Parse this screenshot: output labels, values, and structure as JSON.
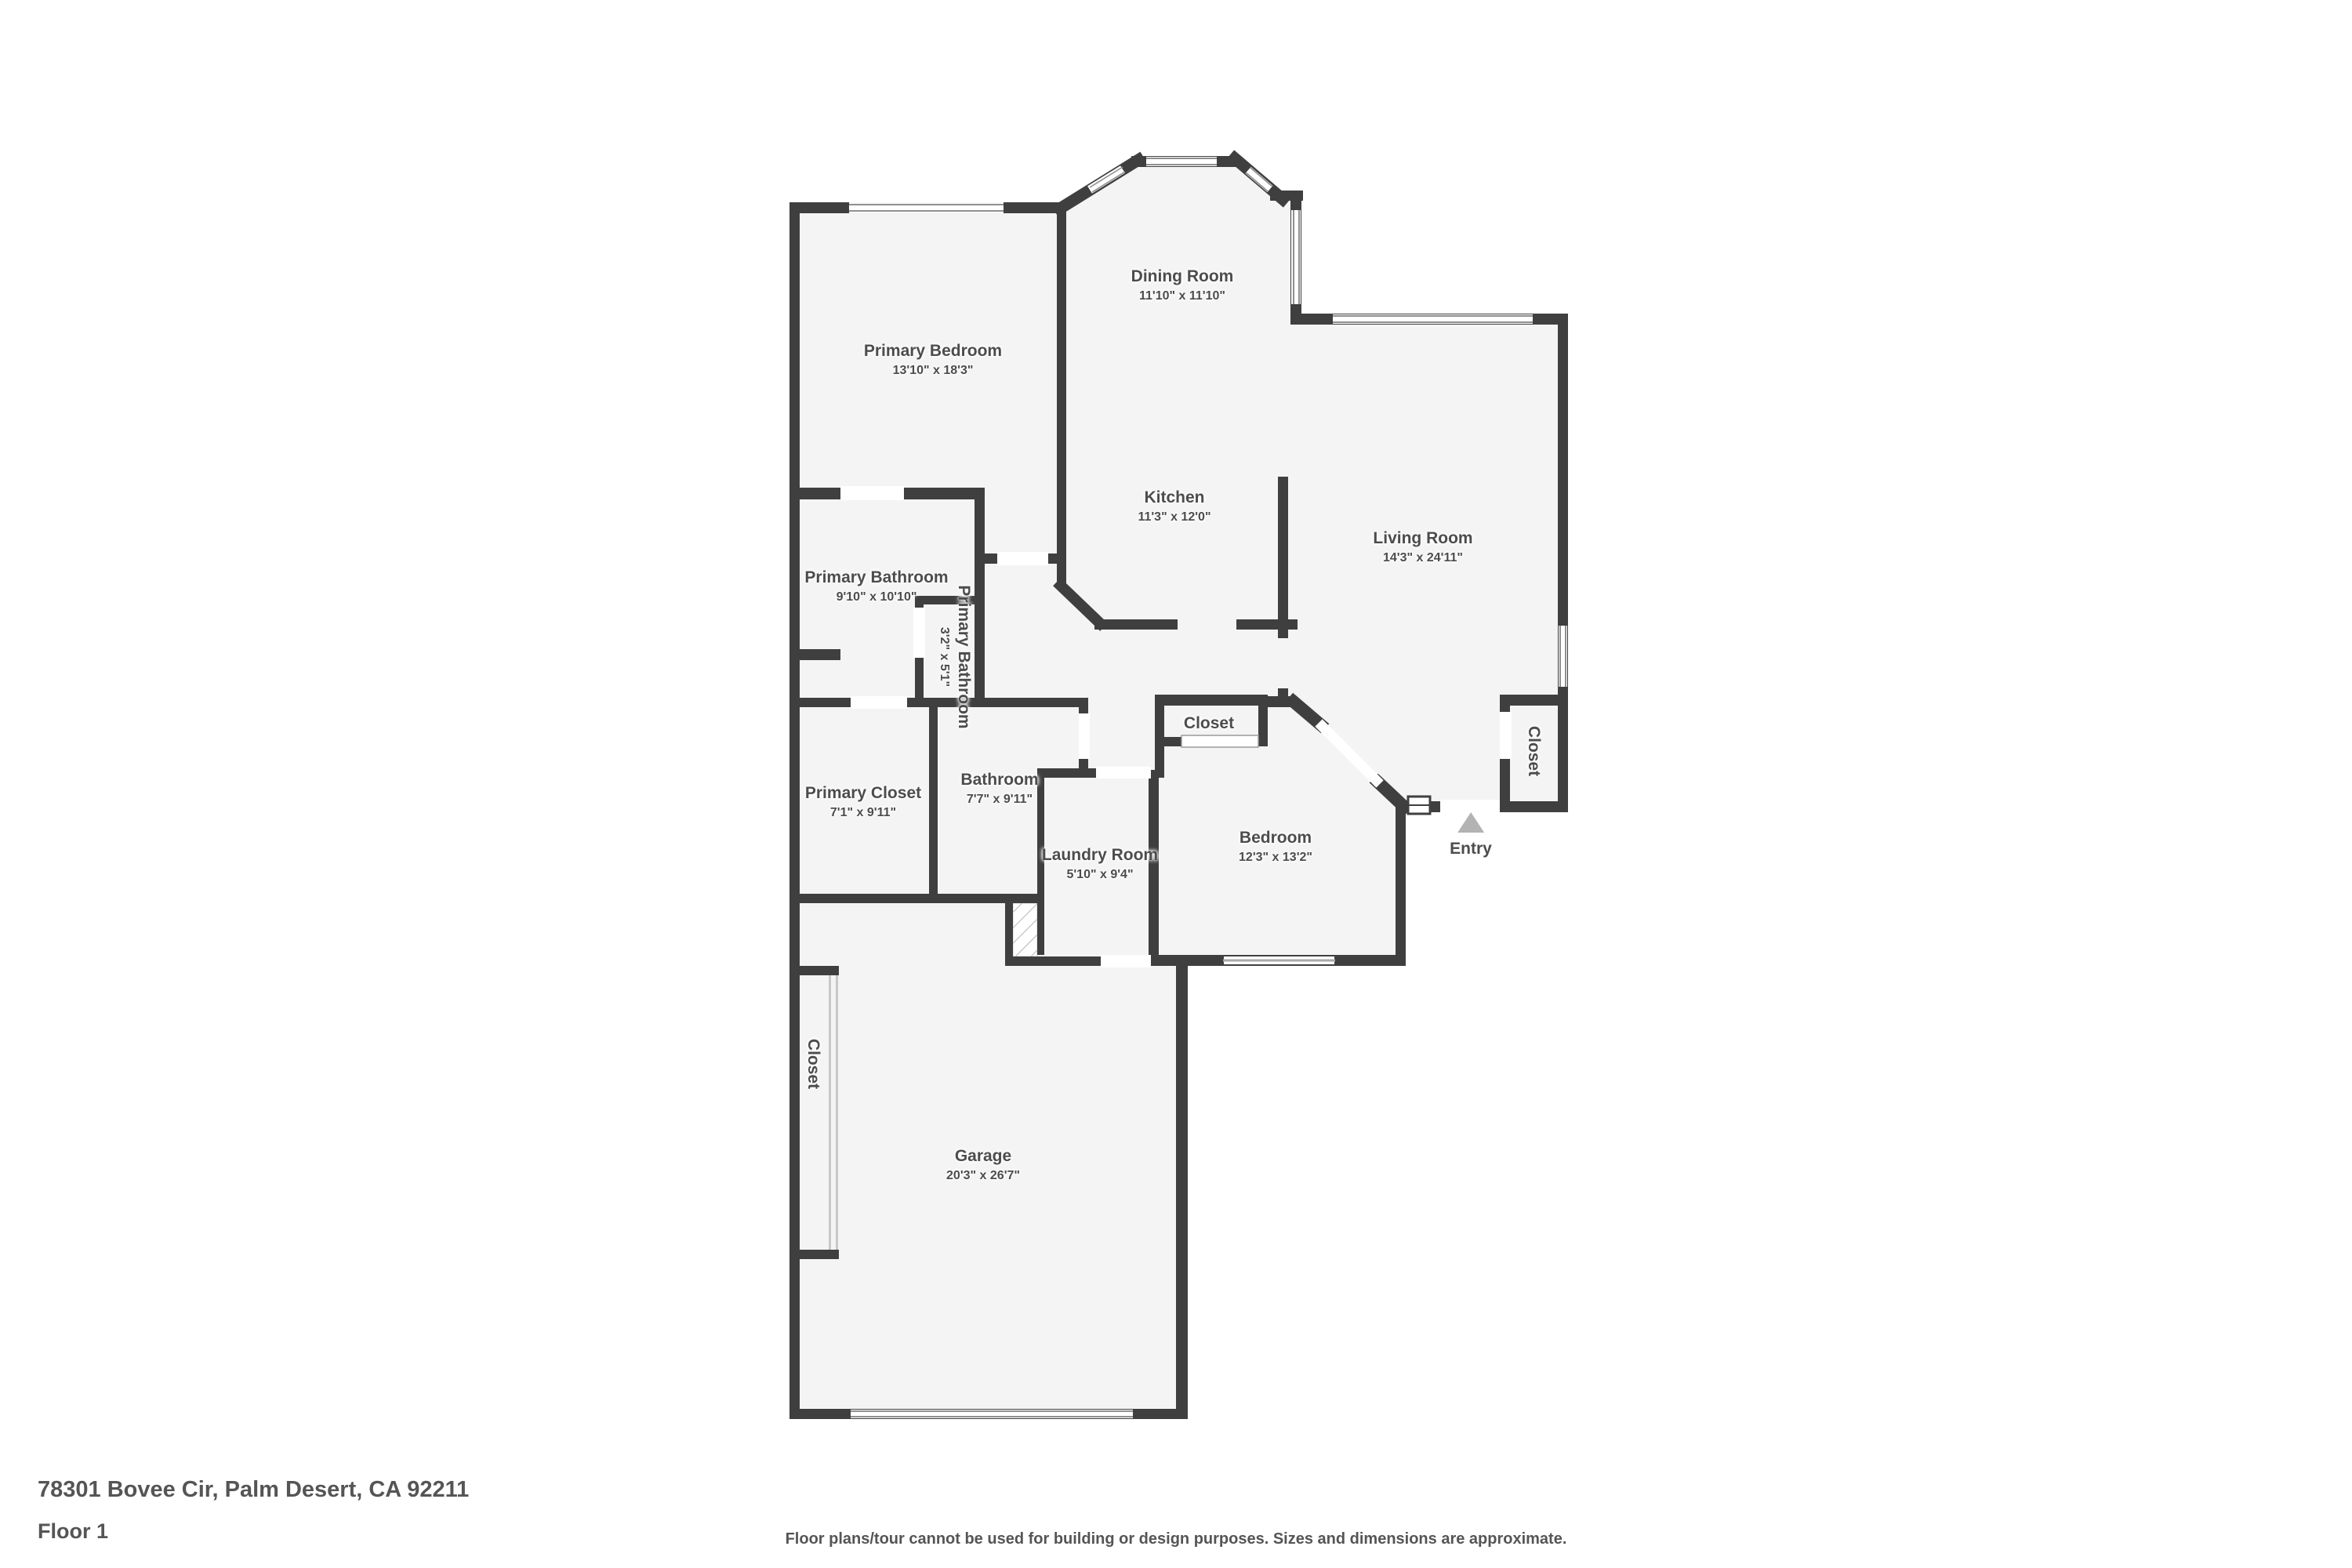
{
  "title_block": {
    "address": "78301 Bovee Cir, Palm Desert, CA 92211",
    "floor": "Floor 1"
  },
  "disclaimer": "Floor plans/tour cannot be used for building or design purposes. Sizes and dimensions are approximate.",
  "entry": {
    "label": "Entry"
  },
  "rooms": [
    {
      "name": "Primary Bedroom",
      "dims": "13'10\" x 18'3\""
    },
    {
      "name": "Dining Room",
      "dims": "11'10\" x 11'10\""
    },
    {
      "name": "Kitchen",
      "dims": "11'3\" x 12'0\""
    },
    {
      "name": "Living Room",
      "dims": "14'3\" x 24'11\""
    },
    {
      "name": "Primary Bathroom",
      "dims": "9'10\" x 10'10\""
    },
    {
      "name": "Primary Bathroom",
      "dims": "3'2\" x 5'1\""
    },
    {
      "name": "Primary Closet",
      "dims": "7'1\" x 9'11\""
    },
    {
      "name": "Bathroom",
      "dims": "7'7\" x 9'11\""
    },
    {
      "name": "Laundry Room",
      "dims": "5'10\" x 9'4\""
    },
    {
      "name": "Bedroom",
      "dims": "12'3\" x 13'2\""
    },
    {
      "name": "Garage",
      "dims": "20'3\" x 26'7\""
    },
    {
      "name": "Closet"
    },
    {
      "name": "Closet"
    },
    {
      "name": "Closet"
    }
  ],
  "colors": {
    "wall": "#3f3f3f",
    "floor": "#f4f4f4",
    "label_text": "#4c4c4c",
    "entry_arrow": "#b3b3b3",
    "window_line": "#8f8f8f"
  }
}
